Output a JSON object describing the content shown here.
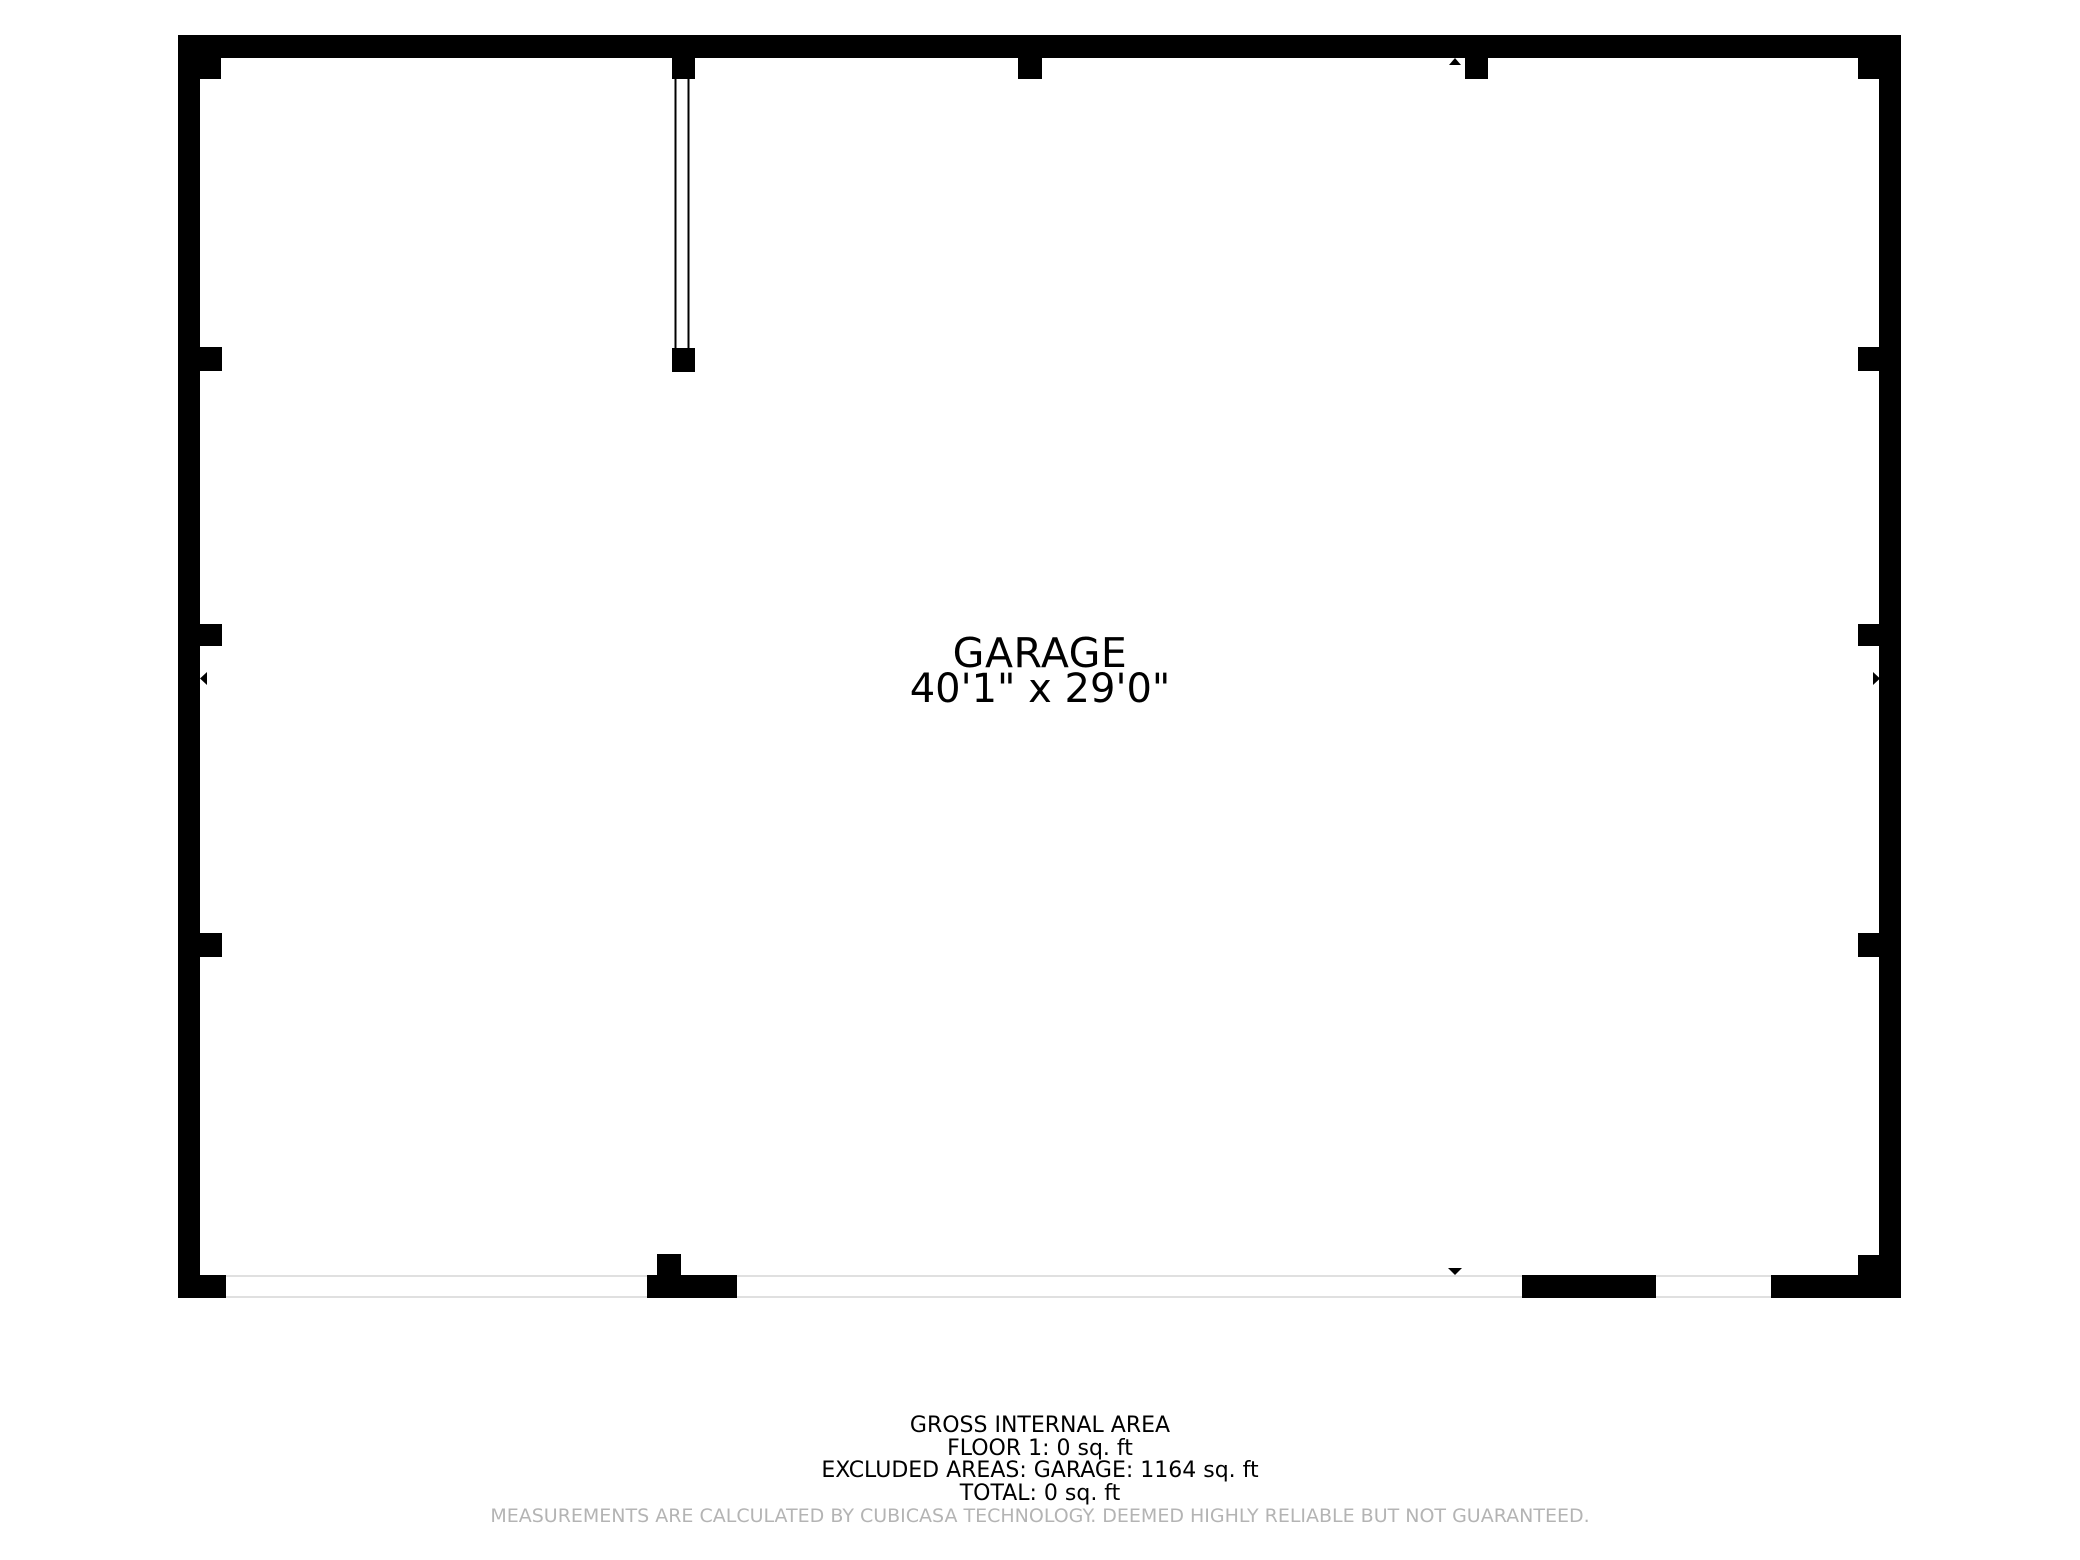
{
  "plan": {
    "room_label": {
      "name": "GARAGE",
      "dimensions": "40'1\" x 29'0\""
    },
    "colors": {
      "wall": "#000000",
      "opening_line": "#e0e0e0",
      "text": "#000000",
      "disclaimer": "#b4b4b4",
      "background": "#ffffff"
    },
    "geometry": {
      "bounds": {
        "x": 178,
        "y": 35,
        "w": 1723,
        "h": 1263
      },
      "walls": [
        {
          "name": "top-wall",
          "x": 178,
          "y": 35,
          "w": 1723,
          "h": 23
        },
        {
          "name": "left-wall",
          "x": 178,
          "y": 35,
          "w": 22,
          "h": 1263
        },
        {
          "name": "right-wall",
          "x": 1879,
          "y": 35,
          "w": 22,
          "h": 1263
        },
        {
          "name": "top-left-corner-post",
          "x": 178,
          "y": 35,
          "w": 43,
          "h": 44
        },
        {
          "name": "top-right-corner-post",
          "x": 1858,
          "y": 35,
          "w": 43,
          "h": 44
        },
        {
          "name": "bottom-left-corner-post",
          "x": 178,
          "y": 1275,
          "w": 48,
          "h": 23
        },
        {
          "name": "bottom-right-corner-post",
          "x": 1858,
          "y": 1255,
          "w": 21,
          "h": 21
        },
        {
          "name": "left-wall-pier-1",
          "x": 200,
          "y": 347,
          "w": 22,
          "h": 24
        },
        {
          "name": "left-wall-pier-2",
          "x": 200,
          "y": 624,
          "w": 22,
          "h": 22
        },
        {
          "name": "left-wall-pier-3",
          "x": 200,
          "y": 933,
          "w": 22,
          "h": 24
        },
        {
          "name": "right-wall-pier-1",
          "x": 1858,
          "y": 347,
          "w": 22,
          "h": 24
        },
        {
          "name": "right-wall-pier-2",
          "x": 1858,
          "y": 624,
          "w": 22,
          "h": 22
        },
        {
          "name": "right-wall-pier-3",
          "x": 1858,
          "y": 933,
          "w": 22,
          "h": 24
        },
        {
          "name": "partition-top-post",
          "x": 672,
          "y": 58,
          "w": 23,
          "h": 21
        },
        {
          "name": "top-wall-pier-1",
          "x": 1018,
          "y": 58,
          "w": 24,
          "h": 21
        },
        {
          "name": "top-wall-pier-2",
          "x": 1465,
          "y": 58,
          "w": 23,
          "h": 21
        },
        {
          "name": "partition-end-post",
          "x": 672,
          "y": 348,
          "w": 23,
          "h": 24
        },
        {
          "name": "bottom-wall-segment-1",
          "x": 647,
          "y": 1275,
          "w": 90,
          "h": 23
        },
        {
          "name": "bottom-wall-stub",
          "x": 657,
          "y": 1254,
          "w": 24,
          "h": 21
        },
        {
          "name": "bottom-wall-segment-2",
          "x": 1522,
          "y": 1275,
          "w": 134,
          "h": 23
        },
        {
          "name": "bottom-wall-segment-3",
          "x": 1771,
          "y": 1275,
          "w": 130,
          "h": 23
        }
      ],
      "opening_lines": [
        {
          "name": "garage-door-line-top",
          "x1": 226,
          "y1": 1276,
          "x2": 1879,
          "y2": 1276
        },
        {
          "name": "garage-door-line-bottom",
          "x1": 226,
          "y1": 1297,
          "x2": 1879,
          "y2": 1297
        }
      ],
      "partition_lines": [
        {
          "name": "partition-line-left",
          "x1": 675.5,
          "y1": 79,
          "x2": 675.5,
          "y2": 348
        },
        {
          "name": "partition-line-right",
          "x1": 688.5,
          "y1": 79,
          "x2": 688.5,
          "y2": 348
        }
      ],
      "arrows": [
        {
          "name": "entry-arrow-up",
          "points": "1449,65 1461,65 1455,58"
        },
        {
          "name": "entry-arrow-down",
          "points": "1448,1268 1462,1268 1455,1275"
        },
        {
          "name": "entry-arrow-left",
          "points": "207,672 207,685 200,678.5"
        },
        {
          "name": "entry-arrow-right",
          "points": "1873,672 1873,685 1880,678.5"
        }
      ]
    }
  },
  "footer": {
    "lines": [
      "GROSS INTERNAL AREA",
      "FLOOR 1: 0 sq. ft",
      "EXCLUDED AREAS: GARAGE: 1164 sq. ft",
      "TOTAL: 0 sq. ft"
    ],
    "disclaimer": "MEASUREMENTS ARE CALCULATED BY CUBICASA TECHNOLOGY. DEEMED HIGHLY RELIABLE BUT NOT GUARANTEED."
  }
}
